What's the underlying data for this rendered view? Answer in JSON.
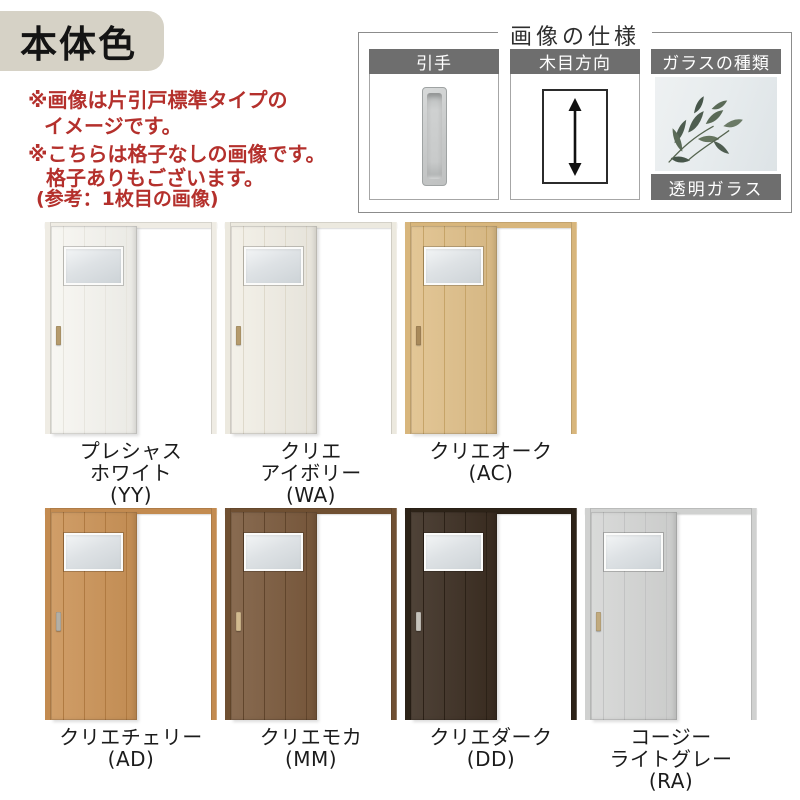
{
  "title_badge": {
    "text": "本体色",
    "bg": "#d6d2c6",
    "text_color": "#141414"
  },
  "notes": {
    "color": "#b4302c",
    "lines": [
      "※画像は片引戸標準タイプの",
      "イメージです。",
      "※こちらは格子なしの画像です。",
      "格子ありもございます。",
      "(参考：1枚目の画像)"
    ]
  },
  "spec_box": {
    "title": "画像の仕様",
    "header_bg": "#6e6e6e",
    "panels": [
      {
        "id": "handle",
        "label": "引手",
        "icon": "recessed-pull-icon"
      },
      {
        "id": "grain",
        "label": "木目方向",
        "icon": "vertical-double-arrow-icon"
      },
      {
        "id": "glass",
        "label": "ガラスの種類",
        "icon": "plant-behind-glass-photo",
        "caption": "透明ガラス"
      }
    ]
  },
  "doors": [
    {
      "code": "YY",
      "label_lines": [
        "プレシャス",
        "ホワイト",
        "(YY)"
      ],
      "colors": {
        "door": "#f7f6f1",
        "groove": "#e7e5de",
        "frame": "#efece4",
        "handle": "#b59b6d"
      }
    },
    {
      "code": "WA",
      "label_lines": [
        "クリエ",
        "アイボリー",
        "(WA)"
      ],
      "colors": {
        "door": "#f2efe6",
        "groove": "#ded9cb",
        "frame": "#ece9df",
        "handle": "#b59b6d"
      }
    },
    {
      "code": "AC",
      "label_lines": [
        "クリエオーク",
        "(AC)"
      ],
      "colors": {
        "door": "#e0c08a",
        "groove": "#c6a468",
        "frame": "#d8b67c",
        "handle": "#a8895a"
      }
    },
    {
      "code": "AD",
      "label_lines": [
        "クリエチェリー",
        "(AD)"
      ],
      "colors": {
        "door": "#cb9357",
        "groove": "#b07a41",
        "frame": "#c38b50",
        "handle": "#b3afa5"
      }
    },
    {
      "code": "MM",
      "label_lines": [
        "クリエモカ",
        "(MM)"
      ],
      "colors": {
        "door": "#7b5a3d",
        "groove": "#61452c",
        "frame": "#705032",
        "handle": "#d2ba8f"
      }
    },
    {
      "code": "DD",
      "label_lines": [
        "クリエダーク",
        "(DD)"
      ],
      "colors": {
        "door": "#3b2d21",
        "groove": "#2c2117",
        "frame": "#2d2318",
        "handle": "#c6c3bc"
      }
    },
    {
      "code": "RA",
      "label_lines": [
        "コージー",
        "ライトグレー",
        "(RA)"
      ],
      "colors": {
        "door": "#d5d6d5",
        "groove": "#c2c3c3",
        "frame": "#d0d1d0",
        "handle": "#c1aa7e"
      }
    }
  ]
}
